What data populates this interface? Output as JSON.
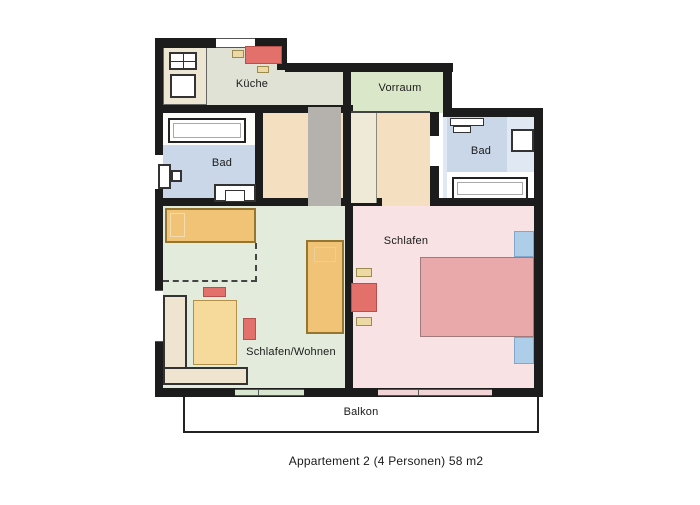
{
  "caption": "Appartement 2 (4 Personen) 58 m2",
  "rooms": {
    "kueche": "Küche",
    "vorraum": "Vorraum",
    "bad_left": "Bad",
    "bad_right": "Bad",
    "schlafen": "Schlafen",
    "schlafen_wohnen": "Schlafen/Wohnen",
    "balkon": "Balkon"
  },
  "palette": {
    "wall": "#1c1c1c",
    "text": "#1a1a1a",
    "kueche": "#e0e2d6",
    "counter": "#ede6d2",
    "vorraum": "#dbe7c9",
    "corridor": "#f4e0c0",
    "grayshaft": "#b5b2ad",
    "cream": "#efe9d8",
    "bad": "#c9d7e9",
    "bad_light": "#dfe8f3",
    "wohnen": "#e3ecdc",
    "schlafen": "#f8e2e4",
    "bed_orange": "#f0c376",
    "bed_yellow": "#f6da9c",
    "sofa_beige": "#efe4d0",
    "red": "#e4706c",
    "bed_pink": "#e9a9ab",
    "pillow_blue": "#aecde9",
    "tan_small": "#ecd9a4",
    "door_green": "#d9e6cf",
    "door_pink": "#f3d4d6"
  }
}
